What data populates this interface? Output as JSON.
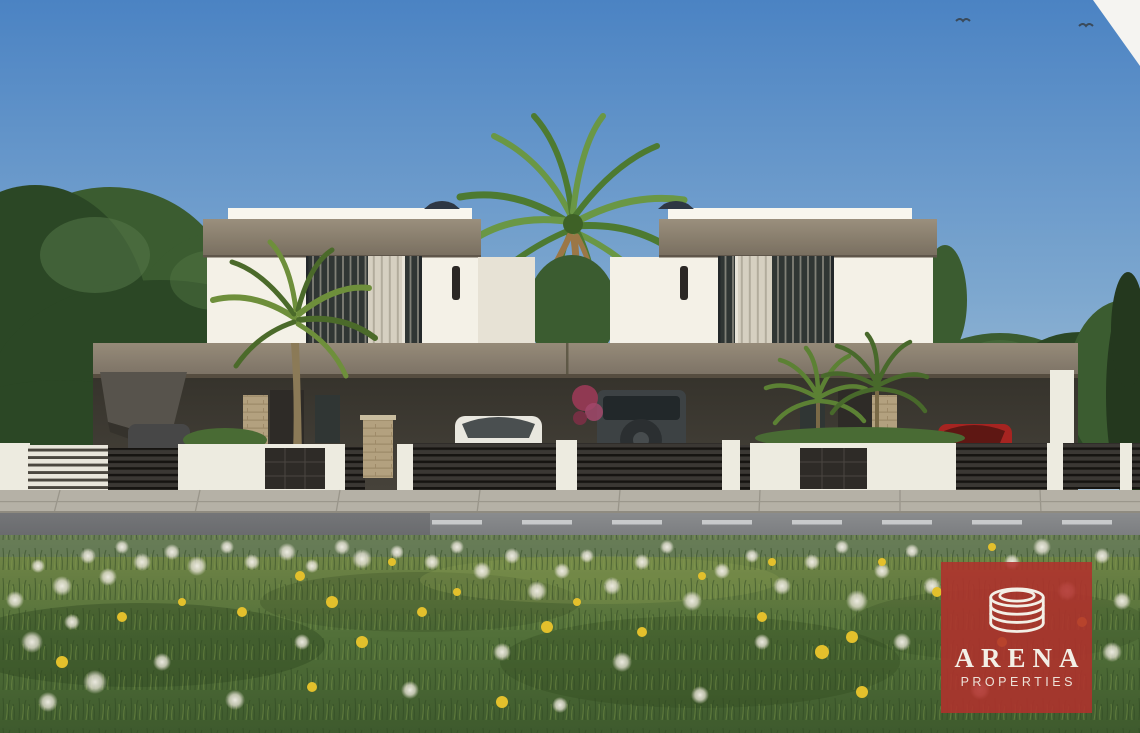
{
  "image": {
    "type": "architectural-render",
    "description": "3D exterior rendering of two modern two-storey white villas with flat roofs, taupe fascia bands, shared carport canopy, parked cars (white sedan, dark SUV with rear spare wheel, red car, grey car), palm trees, dark horizontal-slat fences with white piers, a road with sidewalk, and a wildflower meadow of dandelions in the foreground under a clear blue sky"
  },
  "watermark": {
    "brand": "ARENA",
    "tagline": "PROPERTIES",
    "icon": "arena-rings-icon",
    "background_color": "#b1312c",
    "text_color": "#f3efe6"
  },
  "palette": {
    "sky_top": "#4c83c1",
    "sky_mid": "#7fa8ce",
    "sky_low": "#b6cbda",
    "fascia_hi": "#9a8f7e",
    "fascia_lo": "#786e5f",
    "band_hi": "#968b7a",
    "band_lo": "#7b7164",
    "wall": "#f4f1e7",
    "wall_sh": "#e7e2d5",
    "parapet": "#f8f6ee",
    "glass": "#303634",
    "curtain": "#d6d0c1",
    "shadow_int": "#46423a",
    "slat": "#3b3834",
    "slat_gap": "#161411",
    "pier": "#edebe0",
    "panel": "#2e2b27",
    "stone": "#b3a180",
    "sidewalk": "#b5b1a6",
    "road_hi": "#8a8c8e",
    "road_lo": "#6f7174",
    "dash": "#d9dbdc",
    "grass_hi": "#76894b",
    "grass_mid": "#53703a",
    "grass_lo": "#3f5a2e",
    "tree1": "#3c5c31",
    "tree2": "#2c4726",
    "tree3": "#557748",
    "cypress": "#24381f",
    "palm1": "#4e7a33",
    "palm2": "#6b9747",
    "palm_dead": "#9a7748",
    "trunk": "#8b7a58",
    "car_white": "#e9e7df",
    "car_red": "#a32522",
    "suv": "#3d4244",
    "car_gray": "#474747",
    "puff": "#e9e5da",
    "yellow": "#e2c030",
    "logo_red": "#b1312c",
    "logo_text": "#f3efe6"
  },
  "scene": {
    "objects": [
      "sky",
      "birds",
      "left-tree-mass",
      "right-tree-mass",
      "tall-palm",
      "left-villa",
      "right-villa",
      "carport-canopy",
      "white-sedan",
      "dark-suv",
      "red-car",
      "grey-car",
      "slat-fence",
      "white-piers",
      "front-walls",
      "stone-pillars",
      "sidewalk",
      "road",
      "grass-meadow",
      "white-dandelions",
      "yellow-dandelions",
      "watermark"
    ],
    "birds": [
      [
        963,
        21
      ],
      [
        1086,
        26
      ]
    ],
    "flowers_white": [
      [
        15,
        600,
        9
      ],
      [
        38,
        566,
        7
      ],
      [
        62,
        586,
        10
      ],
      [
        88,
        556,
        8
      ],
      [
        108,
        577,
        9
      ],
      [
        32,
        642,
        11
      ],
      [
        72,
        622,
        8
      ],
      [
        122,
        547,
        7
      ],
      [
        142,
        562,
        9
      ],
      [
        172,
        552,
        8
      ],
      [
        197,
        566,
        10
      ],
      [
        227,
        547,
        7
      ],
      [
        252,
        562,
        8
      ],
      [
        287,
        552,
        9
      ],
      [
        312,
        566,
        7
      ],
      [
        342,
        547,
        8
      ],
      [
        362,
        559,
        10
      ],
      [
        397,
        552,
        7
      ],
      [
        432,
        562,
        8
      ],
      [
        457,
        547,
        7
      ],
      [
        482,
        571,
        9
      ],
      [
        512,
        556,
        8
      ],
      [
        537,
        591,
        10
      ],
      [
        562,
        571,
        8
      ],
      [
        587,
        556,
        7
      ],
      [
        612,
        586,
        9
      ],
      [
        642,
        562,
        8
      ],
      [
        667,
        547,
        7
      ],
      [
        692,
        601,
        10
      ],
      [
        722,
        571,
        8
      ],
      [
        752,
        556,
        7
      ],
      [
        782,
        586,
        9
      ],
      [
        812,
        562,
        8
      ],
      [
        842,
        547,
        7
      ],
      [
        857,
        601,
        11
      ],
      [
        882,
        571,
        8
      ],
      [
        912,
        551,
        7
      ],
      [
        932,
        586,
        9
      ],
      [
        1012,
        562,
        8
      ],
      [
        1042,
        547,
        9
      ],
      [
        1067,
        591,
        10
      ],
      [
        1102,
        556,
        8
      ],
      [
        1122,
        601,
        9
      ],
      [
        95,
        682,
        12
      ],
      [
        48,
        702,
        10
      ],
      [
        162,
        662,
        9
      ],
      [
        302,
        642,
        8
      ],
      [
        502,
        652,
        9
      ],
      [
        622,
        662,
        10
      ],
      [
        762,
        642,
        8
      ],
      [
        902,
        642,
        9
      ],
      [
        1112,
        652,
        10
      ],
      [
        235,
        700,
        10
      ],
      [
        410,
        690,
        9
      ],
      [
        560,
        705,
        8
      ],
      [
        700,
        695,
        9
      ],
      [
        980,
        690,
        10
      ]
    ],
    "flowers_yellow": [
      [
        300,
        576,
        5
      ],
      [
        332,
        602,
        6
      ],
      [
        362,
        642,
        6
      ],
      [
        422,
        612,
        5
      ],
      [
        457,
        592,
        4
      ],
      [
        547,
        627,
        6
      ],
      [
        577,
        602,
        4
      ],
      [
        642,
        632,
        5
      ],
      [
        702,
        576,
        4
      ],
      [
        762,
        617,
        5
      ],
      [
        822,
        652,
        7
      ],
      [
        852,
        637,
        6
      ],
      [
        882,
        562,
        4
      ],
      [
        937,
        592,
        5
      ],
      [
        1002,
        642,
        5
      ],
      [
        772,
        562,
        4
      ],
      [
        242,
        612,
        5
      ],
      [
        182,
        602,
        4
      ],
      [
        122,
        617,
        5
      ],
      [
        62,
        662,
        6
      ],
      [
        392,
        562,
        4
      ],
      [
        992,
        547,
        4
      ],
      [
        1082,
        622,
        5
      ],
      [
        502,
        702,
        6
      ],
      [
        862,
        692,
        6
      ],
      [
        312,
        687,
        5
      ]
    ]
  }
}
